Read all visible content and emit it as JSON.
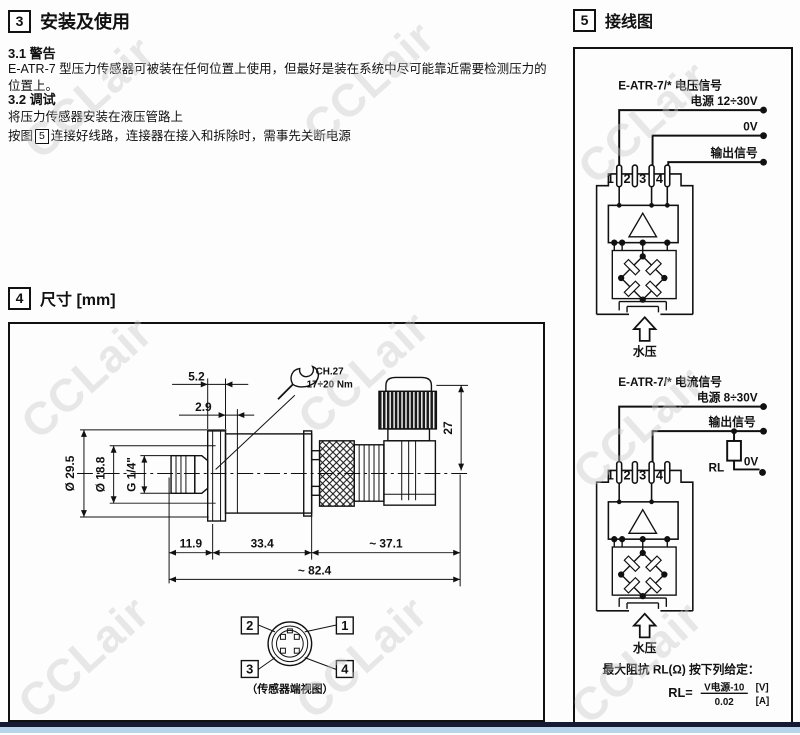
{
  "watermark": {
    "text": "CCLair",
    "color": "#c9c9c9"
  },
  "footer": {
    "line_color": "#161b33",
    "bar_color": "#b9d3ea"
  },
  "section3": {
    "number": "3",
    "title": "安装及使用",
    "warning_heading": "3.1 警告",
    "warning_body": "E-ATR-7 型压力传感器可被装在任何位置上使用，但最好是装在系统中尽可能靠近需要检测压力的位置上。",
    "setup_heading": "3.2 调试",
    "setup_line1": "将压力传感器安装在液压管路上",
    "setup_line2_prefix": "按图",
    "setup_line2_figref": "5",
    "setup_line2_suffix": "连接好线路，连接器在接入和拆除时，需事先关断电源"
  },
  "section4": {
    "number": "4",
    "title": "尺寸 [mm]",
    "dim_5_2": "5.2",
    "dim_2_9": "2.9",
    "wrench_line1": "CH.27",
    "wrench_line2": "17÷20 Nm",
    "dim_27": "27",
    "dim_dia_29_5": "Ø 29.5",
    "dim_dia_18_8": "Ø 18.8",
    "dim_g14": "G 1/4\"",
    "dim_11_9": "11.9",
    "dim_33_4": "33.4",
    "dim_37_1": "~ 37.1",
    "dim_82_4": "~ 82.4",
    "end_view": {
      "pin1": "1",
      "pin2": "2",
      "pin3": "3",
      "pin4": "4",
      "caption": "（传感器端视图）"
    }
  },
  "section5": {
    "number": "5",
    "title": "接线图",
    "voltage": {
      "title": "E-ATR-7/* 电压信号",
      "supply_label": "电源 12÷30V",
      "zero_label": "0V",
      "output_label": "输出信号",
      "pin1": "1",
      "pin2": "2",
      "pin3": "3",
      "pin4": "4",
      "pressure_label": "水压"
    },
    "current": {
      "title": "E-ATR-7/* 电流信号",
      "supply_label": "电源 8÷30V",
      "output_label": "输出信号",
      "rl_label": "RL",
      "zero_label": "0V",
      "pin1": "1",
      "pin2": "2",
      "pin3": "3",
      "pin4": "4",
      "pressure_label": "水压"
    },
    "note": "最大阻抗 RL(Ω) 按下列给定：",
    "formula": {
      "lhs": "RL=",
      "numerator": "V电源-10",
      "denominator": "0.02",
      "unit_top": "[V]",
      "unit_bottom": "[A]"
    }
  }
}
